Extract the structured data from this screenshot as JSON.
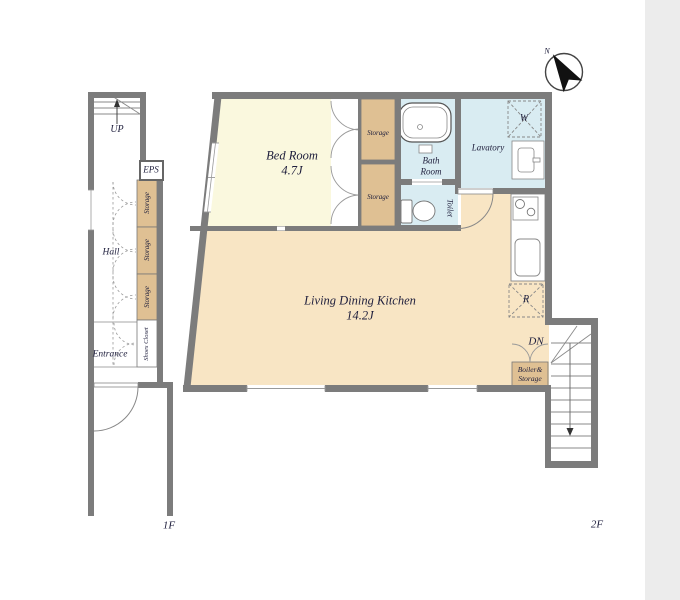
{
  "drawing": "apartment-floor-plan",
  "colors": {
    "bg": "#ffffff",
    "strip": "#ececec",
    "wall": "#7c7c7c",
    "bedroom": "#faf8de",
    "ldk": "#f8e5c4",
    "closet": "#dfc093",
    "wet": "#d9ecf2",
    "line": "#8a8a8a",
    "text": "#1e1e3c"
  },
  "floors": {
    "f1": {
      "label": "1F",
      "stairs_label": "UP",
      "eps_label": "EPS",
      "hall_label": "Hall",
      "entrance_label": "Entrance",
      "storages": [
        "Storage",
        "Storage",
        "Storage"
      ],
      "shoes_closet_label": "Shoes Closet"
    },
    "f2": {
      "label": "2F",
      "bedroom_name": "Bed Room",
      "bedroom_size": "4.7J",
      "ldk_name": "Living Dining Kitchen",
      "ldk_size": "14.2J",
      "lavatory_label": "Lavatory",
      "bath_line1": "Bath",
      "bath_line2": "Room",
      "toilet_label": "Toilet",
      "washer_label": "W",
      "fridge_label": "R",
      "storages": [
        "Storage",
        "Storage"
      ],
      "dn_label": "DN",
      "boiler_line1": "Boiler&",
      "boiler_line2": "Storage",
      "compass_label": "N"
    }
  }
}
